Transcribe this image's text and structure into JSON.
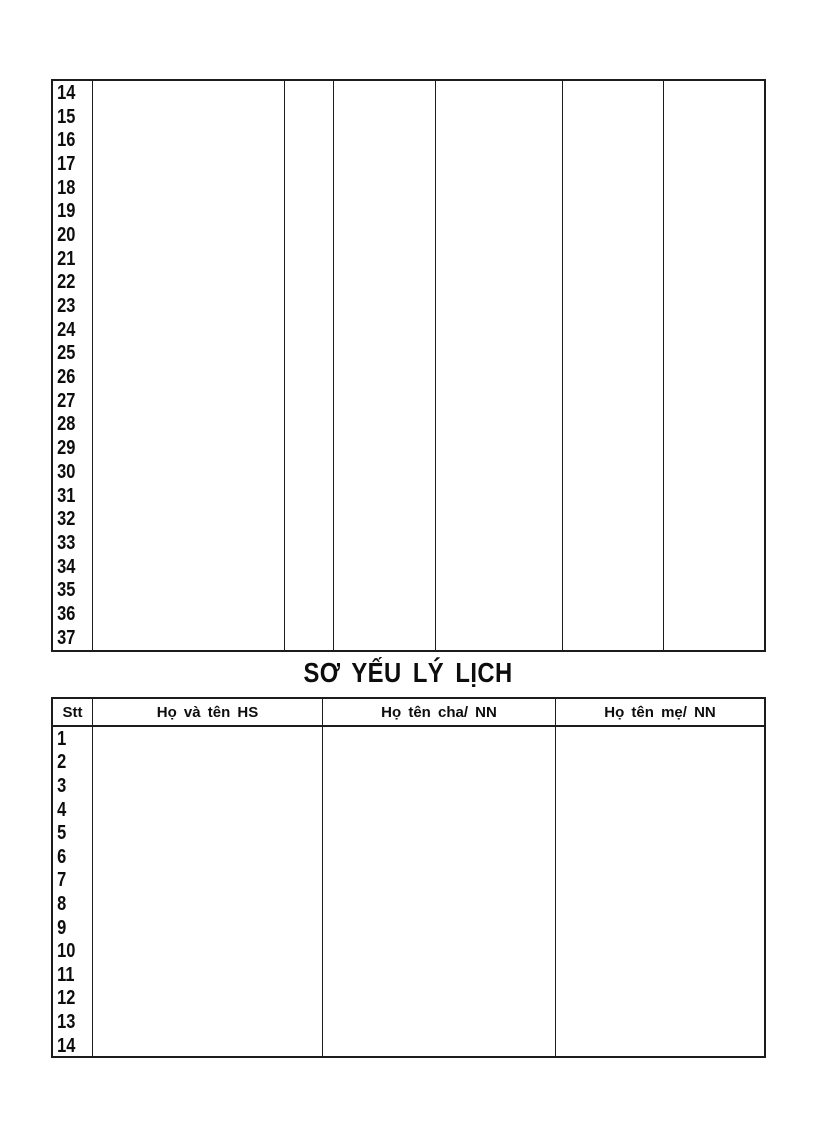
{
  "title": "SƠ YẾU LÝ LỊCH",
  "colors": {
    "ink": "#0d0d0d",
    "border": "#1c1c1c",
    "page_background": "#ffffff"
  },
  "continuation_table": {
    "row_numbers": [
      "14",
      "15",
      "16",
      "17",
      "18",
      "19",
      "20",
      "21",
      "22",
      "23",
      "24",
      "25",
      "26",
      "27",
      "28",
      "29",
      "30",
      "31",
      "32",
      "33",
      "34",
      "35",
      "36",
      "37"
    ]
  },
  "roster_table": {
    "headers": [
      "Stt",
      "Họ và tên HS",
      "Họ tên cha/ NN",
      "Họ tên mẹ/ NN"
    ],
    "row_numbers": [
      "1",
      "2",
      "3",
      "4",
      "5",
      "6",
      "7",
      "8",
      "9",
      "10",
      "11",
      "12",
      "13",
      "14"
    ]
  }
}
